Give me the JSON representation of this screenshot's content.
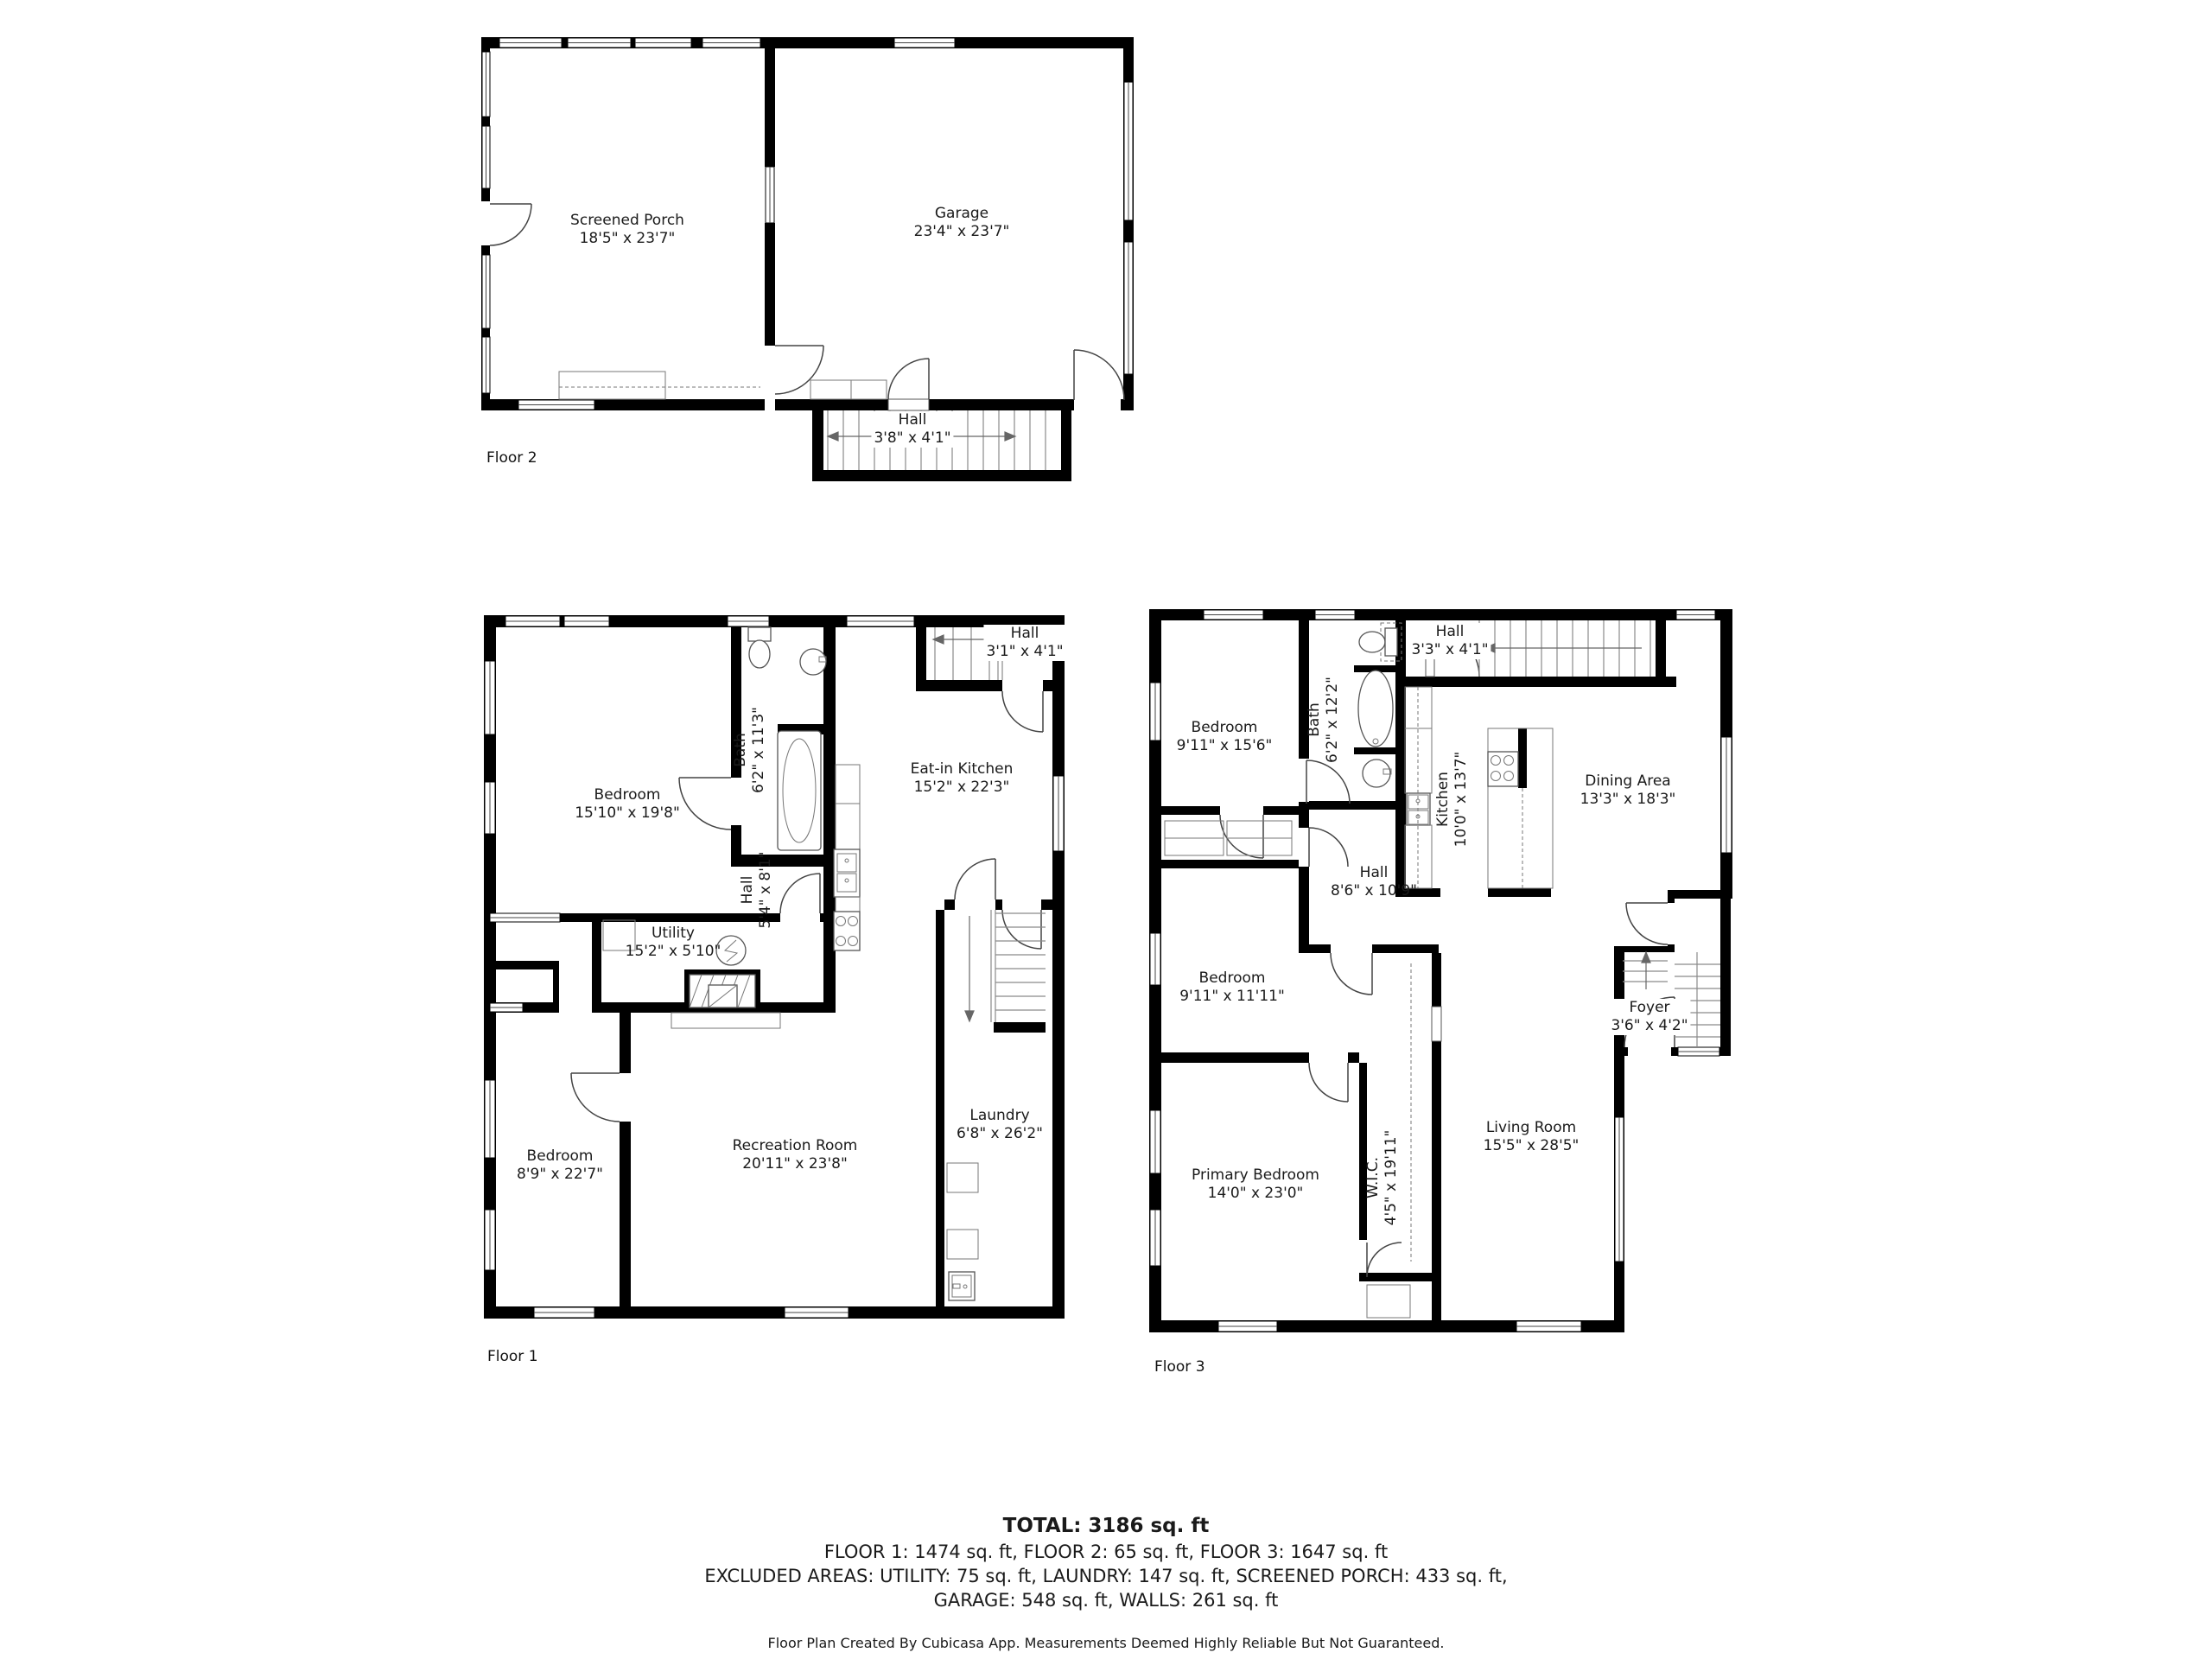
{
  "floors": [
    {
      "caption": "Floor 2",
      "rooms": [
        {
          "name": "Screened Porch",
          "dims": "18'5\" x 23'7\""
        },
        {
          "name": "Garage",
          "dims": "23'4\" x 23'7\""
        },
        {
          "name": "Hall",
          "dims": "3'8\" x 4'1\""
        }
      ]
    },
    {
      "caption": "Floor 1",
      "rooms": [
        {
          "name": "Bedroom",
          "dims": "15'10\" x 19'8\""
        },
        {
          "name": "Bath",
          "dims": "6'2\" x 11'3\""
        },
        {
          "name": "Hall",
          "dims": "3'1\" x 4'1\""
        },
        {
          "name": "Eat-in Kitchen",
          "dims": "15'2\" x 22'3\""
        },
        {
          "name": "Hall",
          "dims": "5'4\" x 8'1\""
        },
        {
          "name": "Utility",
          "dims": "15'2\" x 5'10\""
        },
        {
          "name": "Recreation Room",
          "dims": "20'11\" x 23'8\""
        },
        {
          "name": "Bedroom",
          "dims": "8'9\" x 22'7\""
        },
        {
          "name": "Laundry",
          "dims": "6'8\" x 26'2\""
        }
      ]
    },
    {
      "caption": "Floor 3",
      "rooms": [
        {
          "name": "Bedroom",
          "dims": "9'11\" x 15'6\""
        },
        {
          "name": "Bath",
          "dims": "6'2\" x 12'2\""
        },
        {
          "name": "Hall",
          "dims": "3'3\" x 4'1\""
        },
        {
          "name": "Kitchen",
          "dims": "10'0\" x 13'7\""
        },
        {
          "name": "Dining Area",
          "dims": "13'3\" x 18'3\""
        },
        {
          "name": "Hall",
          "dims": "8'6\" x 10'9\""
        },
        {
          "name": "Bedroom",
          "dims": "9'11\" x 11'11\""
        },
        {
          "name": "W.I.C.",
          "dims": "4'5\" x 19'11\""
        },
        {
          "name": "Foyer",
          "dims": "3'6\" x 4'2\""
        },
        {
          "name": "Living Room",
          "dims": "15'5\" x 28'5\""
        },
        {
          "name": "Primary Bedroom",
          "dims": "14'0\" x 23'0\""
        }
      ]
    }
  ],
  "summary": {
    "total": "TOTAL: 3186 sq. ft",
    "floors_line": "FLOOR 1: 1474 sq. ft, FLOOR 2: 65 sq. ft, FLOOR 3: 1647 sq. ft",
    "excluded_line1": "EXCLUDED AREAS: UTILITY: 75 sq. ft, LAUNDRY: 147 sq. ft, SCREENED PORCH: 433 sq. ft,",
    "excluded_line2": "GARAGE: 548 sq. ft, WALLS: 261 sq. ft",
    "footer": "Floor Plan Created By Cubicasa App. Measurements Deemed Highly Reliable But Not Guaranteed."
  }
}
